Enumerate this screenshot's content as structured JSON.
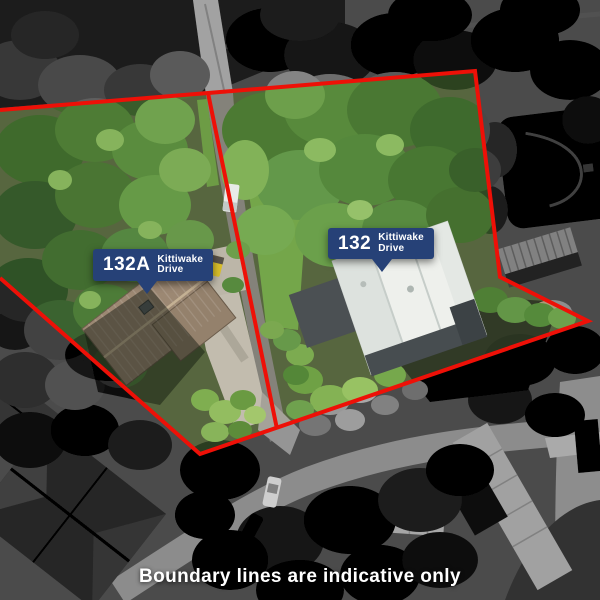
{
  "page": {
    "caption": "Boundary lines are indicative only"
  },
  "labels": [
    {
      "number": "132A",
      "street_line1": "Kittiwake",
      "street_line2": "Drive"
    },
    {
      "number": "132",
      "street_line1": "Kittiwake",
      "street_line2": "Drive"
    }
  ],
  "colors": {
    "boundary_red": "#ee1007",
    "badge_blue": "#264177",
    "caption_text": "#ffffff"
  }
}
